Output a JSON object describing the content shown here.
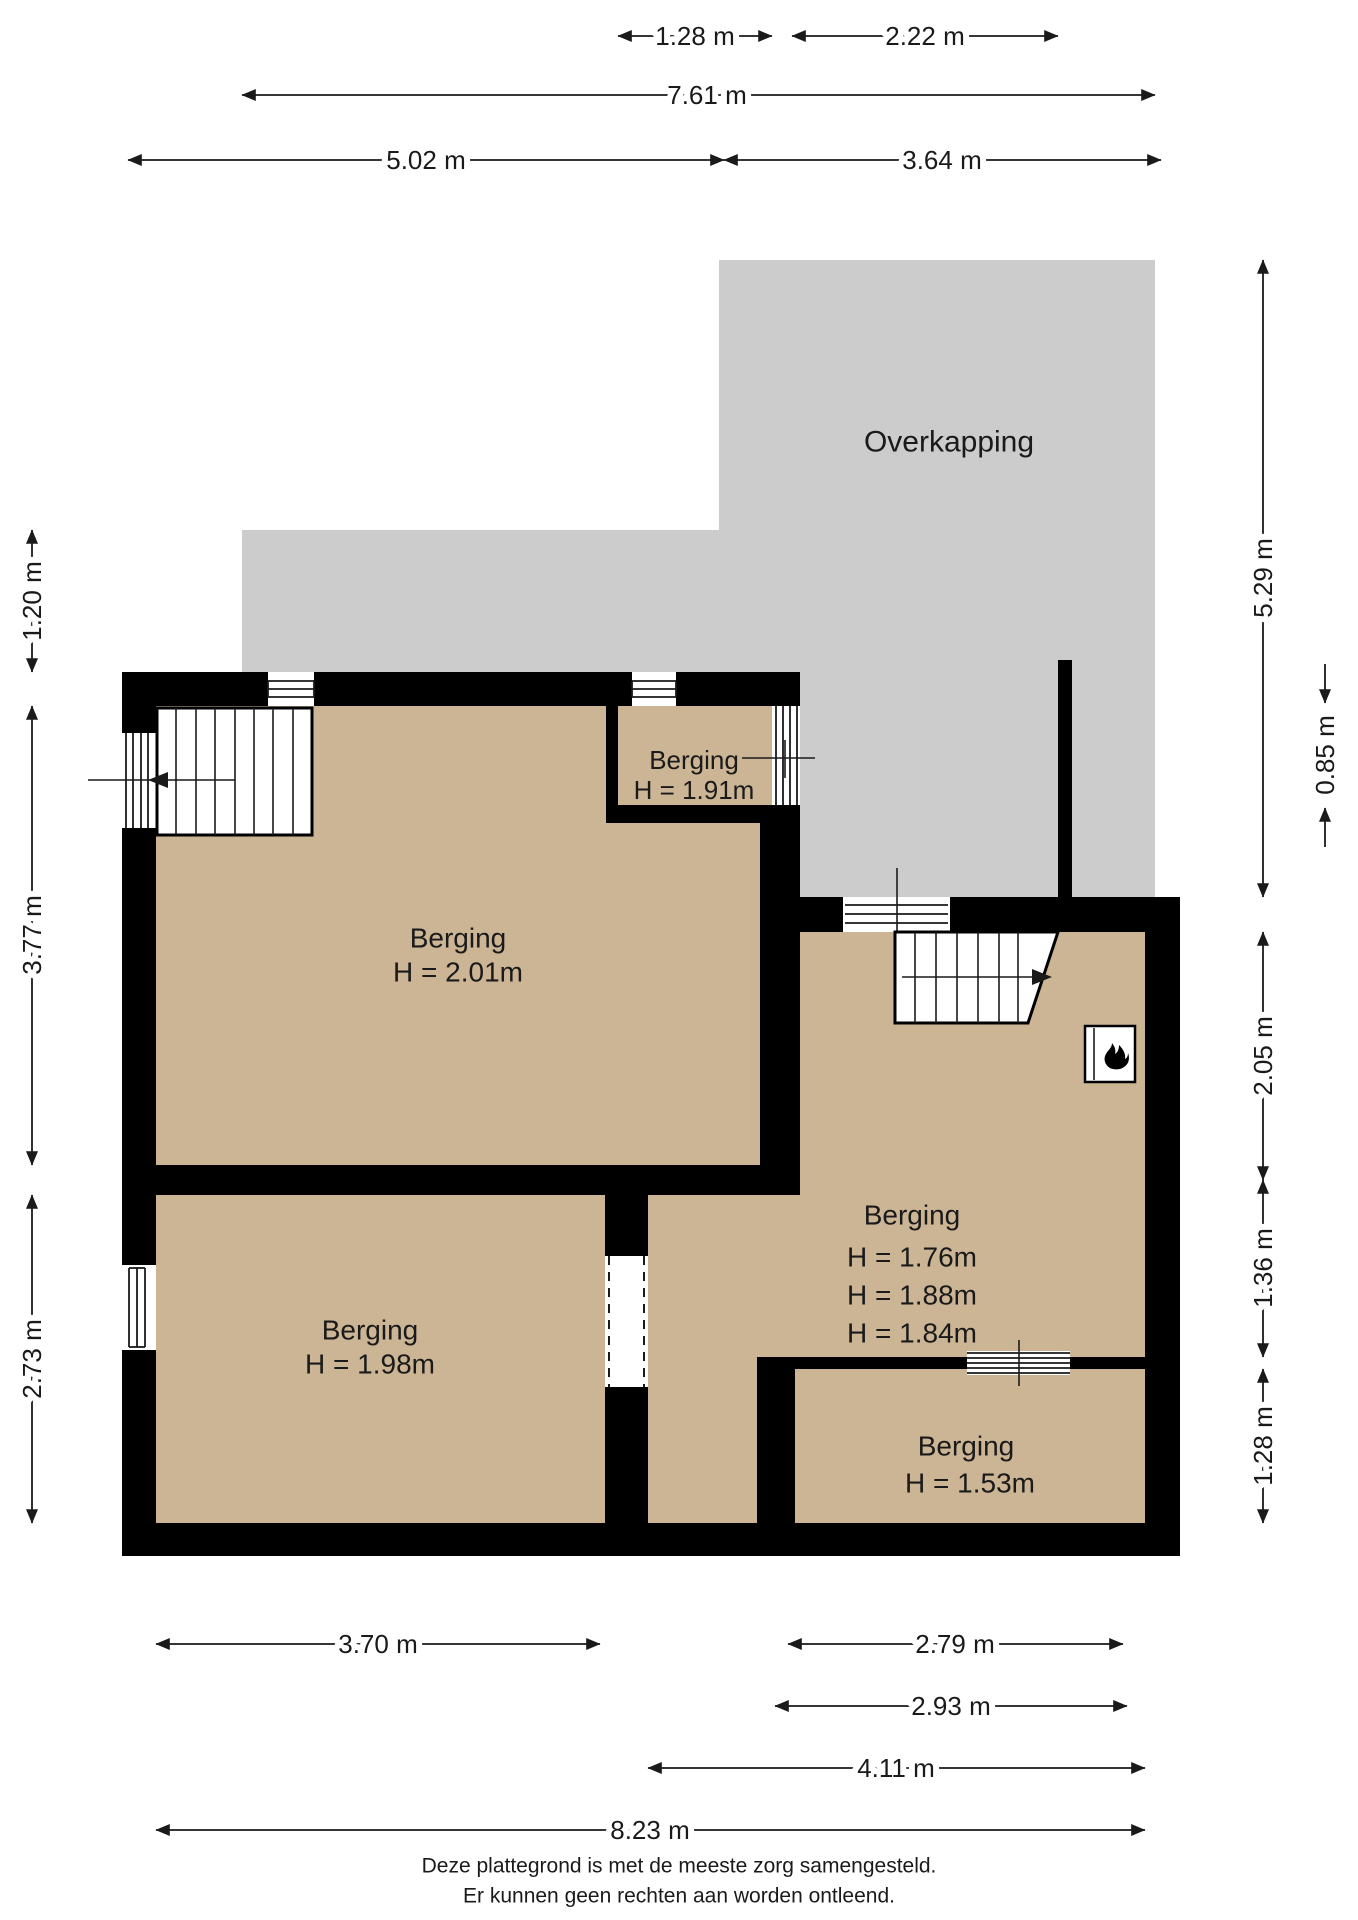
{
  "overkapping": {
    "label": "Overkapping"
  },
  "rooms": {
    "berging_201": {
      "name": "Berging",
      "height": "H = 2.01m"
    },
    "berging_191": {
      "name": "Berging",
      "height": "H = 1.91m"
    },
    "berging_176": {
      "name": "Berging",
      "heights": [
        "H = 1.76m",
        "H = 1.88m",
        "H = 1.84m"
      ]
    },
    "berging_198": {
      "name": "Berging",
      "height": "H = 1.98m"
    },
    "berging_153": {
      "name": "Berging",
      "height": "H = 1.53m"
    }
  },
  "dims": {
    "top_128": "1.28 m",
    "top_222": "2.22 m",
    "top_761": "7.61 m",
    "top_502": "5.02 m",
    "top_364": "3.64 m",
    "left_120": "1.20 m",
    "left_377": "3.77 m",
    "left_273": "2.73 m",
    "right_529": "5.29 m",
    "right_085": "0.85 m",
    "right_205": "2.05 m",
    "right_136": "1.36 m",
    "right_128": "1.28 m",
    "bottom_370": "3.70 m",
    "bottom_279": "2.79 m",
    "bottom_293": "2.93 m",
    "bottom_411": "4.11 m",
    "bottom_823": "8.23 m"
  },
  "footer": {
    "line1": "Deze plattegrond is met de meeste zorg samengesteld.",
    "line2": "Er kunnen geen rechten aan worden ontleend."
  },
  "colors": {
    "floor": "#ccb594",
    "overkapping": "#cccccc",
    "wall": "#000000",
    "text": "#1a1a1a"
  }
}
